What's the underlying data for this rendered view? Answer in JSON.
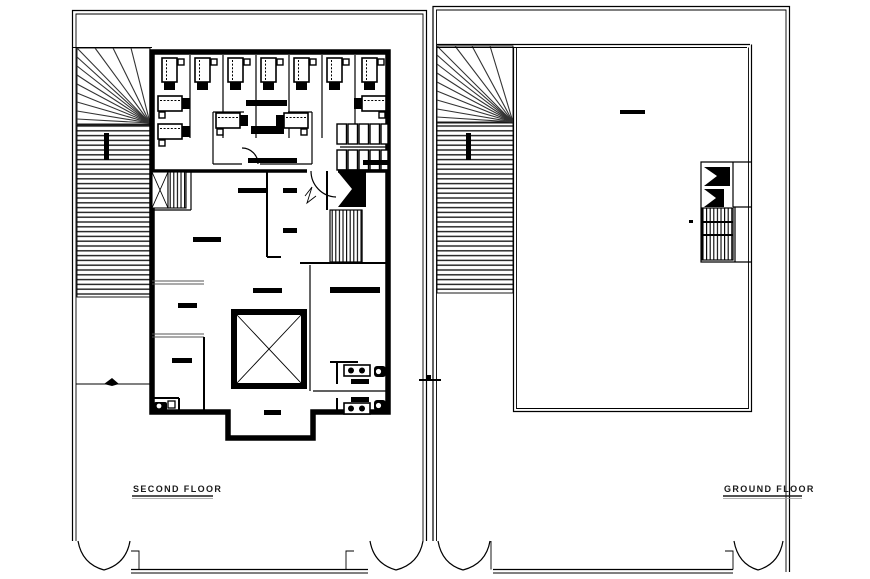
{
  "window": {
    "background_color": "#ffffff",
    "ink_color": "#000000"
  },
  "plans": [
    {
      "name": "second-floor-plan",
      "label": "SECOND FLOOR",
      "components": [
        "site-boundary",
        "ramp-fan-hatch",
        "workstation-cubicles",
        "conference-room",
        "storage-lockers",
        "staircase-left",
        "staircase-right",
        "elevator-shaft",
        "restrooms",
        "entrance-double-doors"
      ]
    },
    {
      "name": "ground-floor-plan",
      "label": "GROUND FLOOR",
      "components": [
        "site-boundary",
        "ramp-fan-hatch",
        "open-hall",
        "staircase",
        "entrance-double-doors"
      ]
    }
  ]
}
